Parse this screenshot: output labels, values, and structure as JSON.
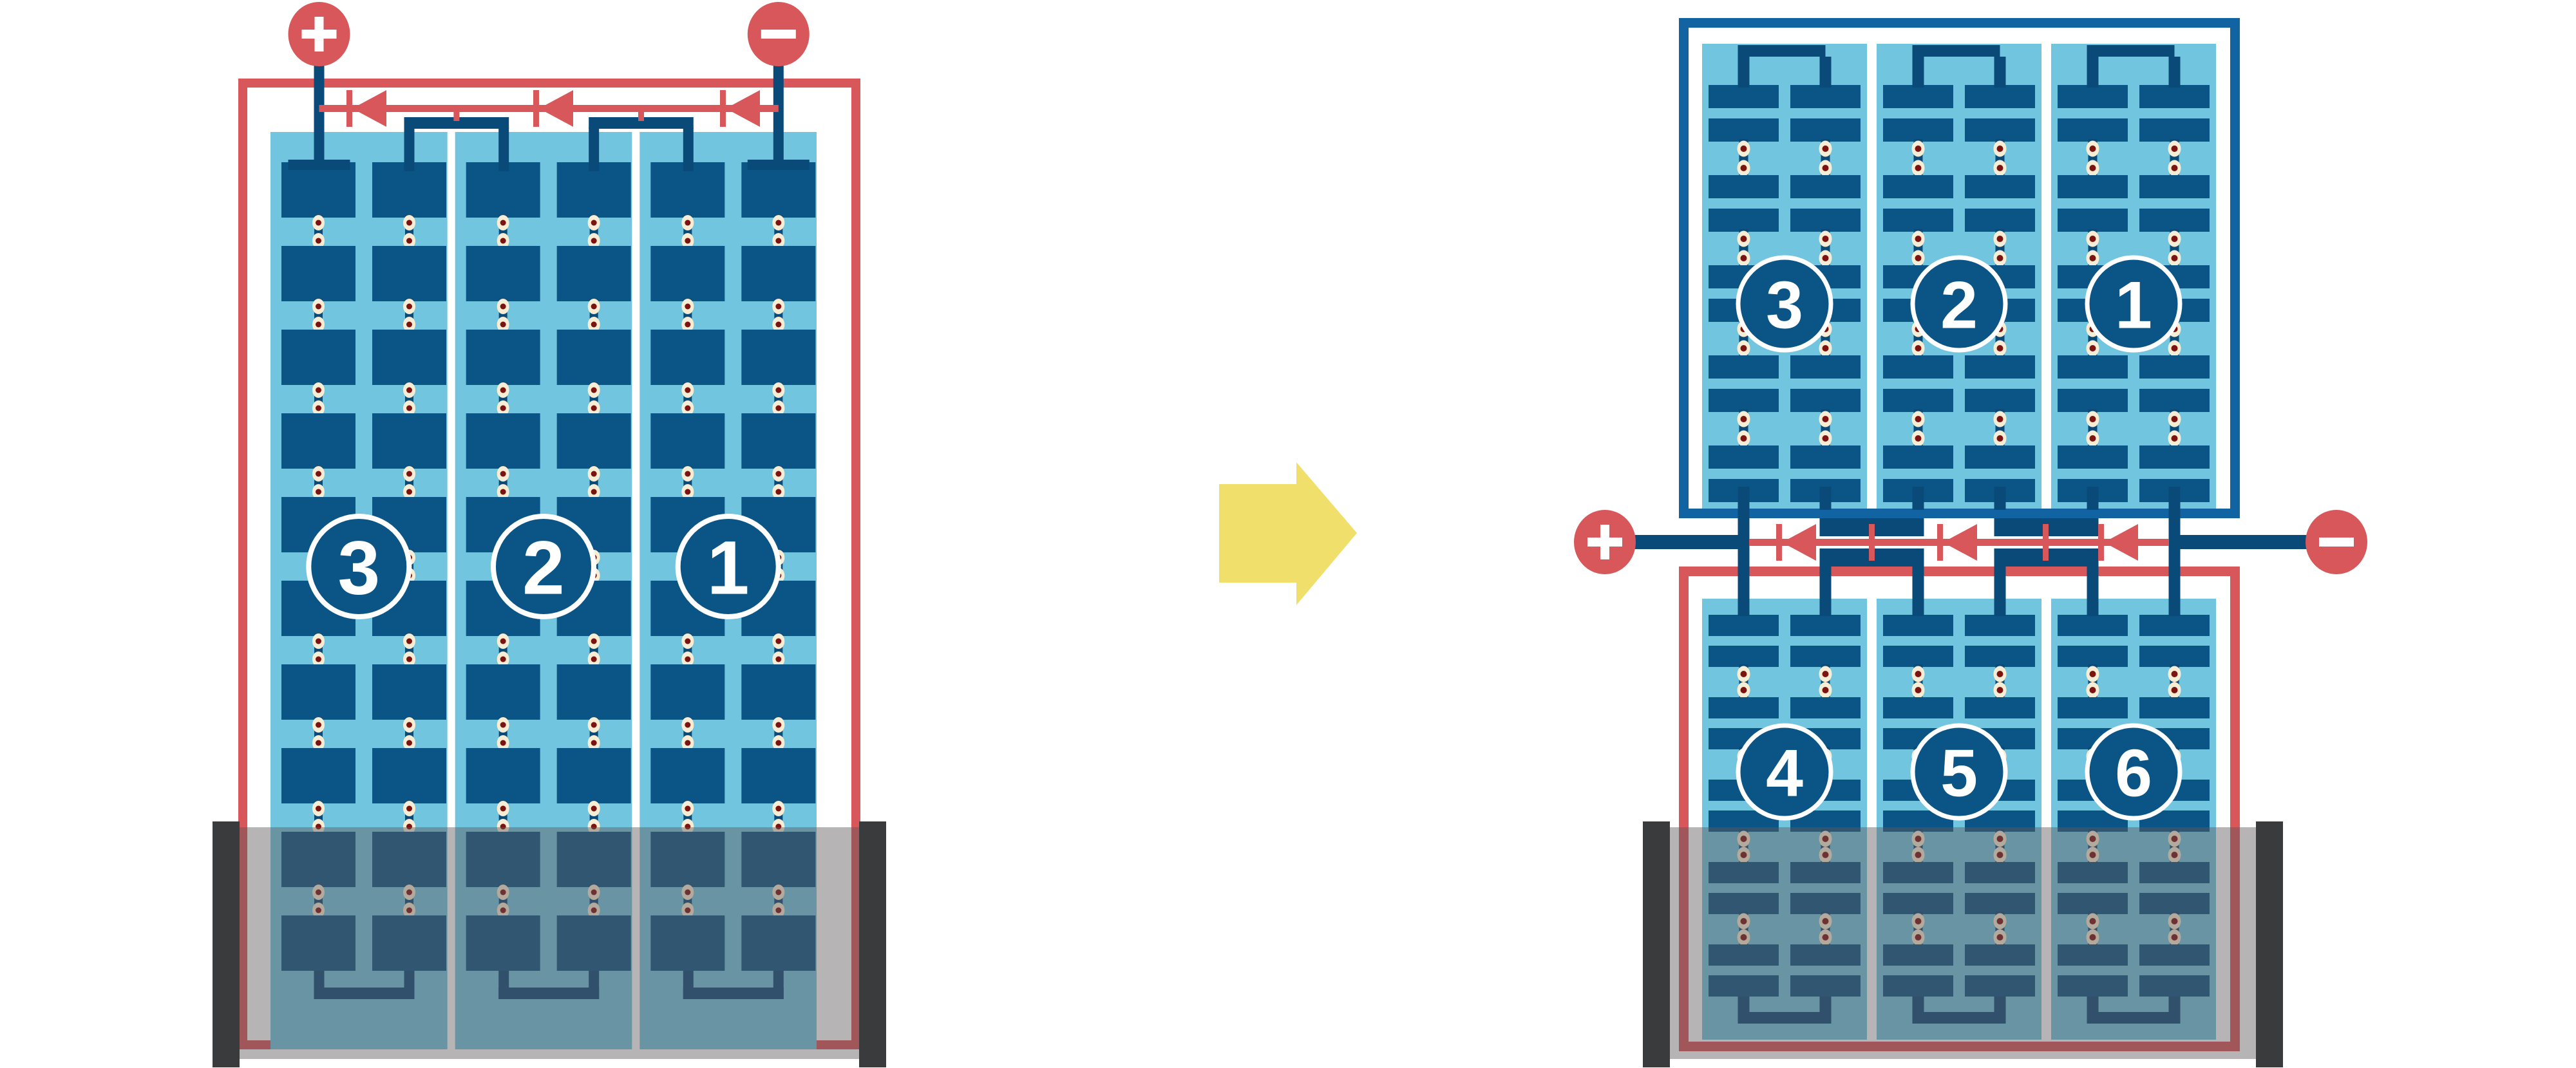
{
  "figure": {
    "description": "Solar panel string wiring comparison: full-cell series panel versus half-cut cell split panel with central junction",
    "shading_note": "lower portion of both panels overlaid by shadow band"
  },
  "colors": {
    "red": "#D8575A",
    "navy": "#0A4A78",
    "cell": "#0B5586",
    "panel": "#72C5DF",
    "frame": "#1263A2",
    "cream": "#F7EDD4",
    "dot": "#7B1311",
    "yellow": "#F1DF6C",
    "bar": "#3A3B3D",
    "shade": "rgba(96,88,90,0.45)"
  },
  "left_diagram": {
    "terminals": {
      "positive_label": "+",
      "negative_label": "−"
    },
    "string_labels": [
      "3",
      "2",
      "1"
    ],
    "bypass_diodes": 3,
    "shading": "bottom"
  },
  "right_diagram": {
    "terminals": {
      "positive_label": "+",
      "negative_label": "−"
    },
    "top_string_labels": [
      "3",
      "2",
      "1"
    ],
    "bottom_string_labels": [
      "4",
      "5",
      "6"
    ],
    "bypass_diodes": 3,
    "shading": "bottom"
  },
  "arrow": {
    "direction": "right"
  }
}
